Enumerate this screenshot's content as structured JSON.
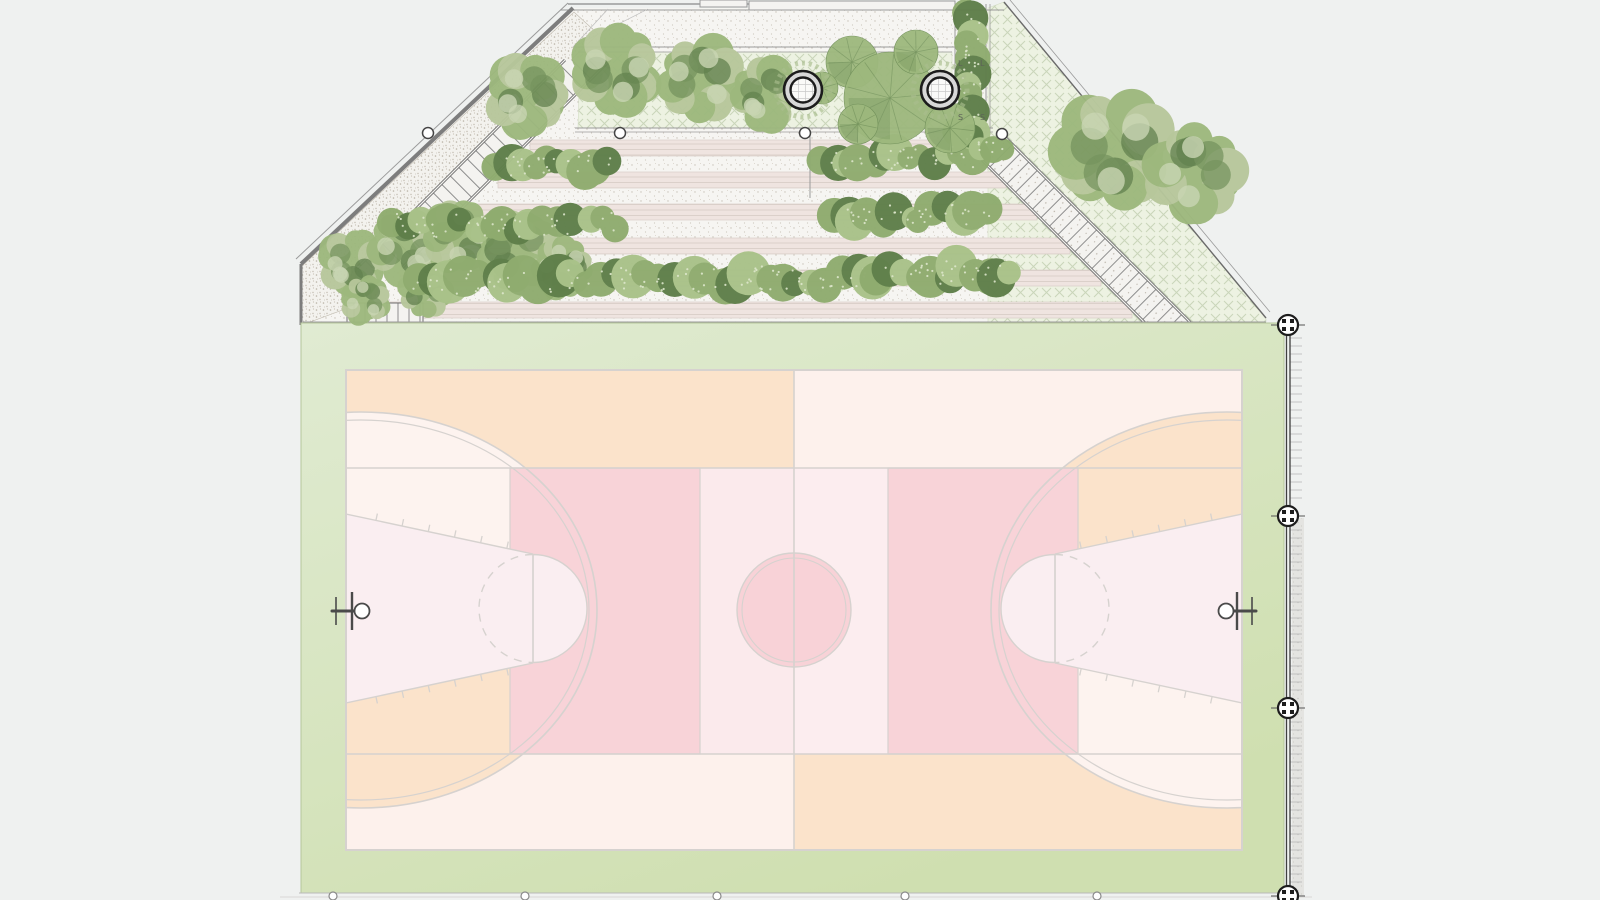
{
  "canvas": {
    "w": 1600,
    "h": 900,
    "bg": "#eff1f0"
  },
  "palette": {
    "bg": "#eff1f0",
    "paper": "#f6f5f2",
    "stipple_dot": "#c9c3b9",
    "terrace_band": "#efe4e0",
    "terrace_line": "#d9cec8",
    "hatch_bg": "#edf2e2",
    "hatch_line": "#c9d5b9",
    "wall": "#7d7d7d",
    "line_gray": "#9a9a9a",
    "light_line": "#bdbdbd",
    "stair_rail": "#6e6e6e",
    "tread": "#8e8e8e",
    "lawn_light": "#e0ebd2",
    "lawn": "#cfdfb0",
    "lawn_edge": "#b5c69b",
    "court_cream": "#fdf1ec",
    "court_peach": "#fbe3cb",
    "court_white": "#fdf3ef",
    "court_pink": "#f8d3d8",
    "court_lightpink_l": "#fbeaec",
    "court_lightpink_r": "#fcedef",
    "court_lane": "#faeef1",
    "court_circle": "#f8d2d7",
    "court_line": "#d6d2cf",
    "tree_base": "#9db87d",
    "tree_dark": "#71905a",
    "tree_deep": "#5d7d49",
    "tree_light": "#b7c79b",
    "tree_pale": "#c8d4b2",
    "hedge_base": "#8fac6f",
    "hedge_dark": "#5f7f4a",
    "hedge_light": "#a9c289",
    "hedge_speckle": "#dde7cb",
    "planter_ring": "#d8d8d8",
    "planter_stroke": "#1c1c1c",
    "planter_grid": "#c9c9c9",
    "organic_ring": "#a9bd8e",
    "fence": "#3f3f3f",
    "marker": "#1d1d1d",
    "tick": "#b8b8b8",
    "sidewalk": "#e4e4e1",
    "sidewalk_dot": "#c6c5c1",
    "node_stroke": "#444444",
    "hoop": "#4a4a4a",
    "label": "#5d6258"
  },
  "labels": {
    "plant_tags": [
      {
        "text": "L",
        "x": 958,
        "y": 66
      },
      {
        "text": "L",
        "x": 980,
        "y": 66
      },
      {
        "text": "S",
        "x": 958,
        "y": 120
      },
      {
        "text": "S",
        "x": 980,
        "y": 120
      }
    ]
  },
  "garden": {
    "base_polygon": [
      [
        573,
        8
      ],
      [
        988,
        8
      ],
      [
        988,
        131
      ],
      [
        1008,
        131
      ],
      [
        1197,
        322
      ],
      [
        303,
        322
      ],
      [
        303,
        264
      ]
    ],
    "hatch_areas": [
      {
        "name": "upper-planting-strip",
        "points": [
          [
            580,
            52
          ],
          [
            952,
            52
          ],
          [
            952,
            128
          ],
          [
            578,
            128
          ]
        ]
      },
      {
        "name": "east-meadow",
        "points": [
          [
            988,
            8
          ],
          [
            1004,
            2
          ],
          [
            1266,
            318
          ],
          [
            1266,
            322
          ],
          [
            988,
            322
          ]
        ]
      }
    ],
    "terrace_rows": [
      {
        "y0": 140,
        "y1": 156,
        "xl": 530,
        "xr": 958
      },
      {
        "y0": 172,
        "y1": 188,
        "xl": 498,
        "xr": 1006
      },
      {
        "y0": 204,
        "y1": 220,
        "xl": 466,
        "xr": 1037
      },
      {
        "y0": 238,
        "y1": 254,
        "xl": 432,
        "xr": 1070
      },
      {
        "y0": 270,
        "y1": 286,
        "xl": 400,
        "xr": 1101
      },
      {
        "y0": 302,
        "y1": 318,
        "xl": 368,
        "xr": 1132
      }
    ],
    "stipple_bed": [
      [
        302,
        266
      ],
      [
        574,
        12
      ],
      [
        598,
        34
      ],
      [
        356,
        268
      ],
      [
        356,
        305
      ],
      [
        302,
        325
      ]
    ],
    "stairs_left": {
      "band": [
        [
          565,
          60
        ],
        [
          610,
          60
        ],
        [
          402,
          268
        ],
        [
          357,
          268
        ]
      ]
    },
    "stairs_right": {
      "band": [
        [
          1005,
          137
        ],
        [
          1193,
          325
        ],
        [
          1170,
          348
        ],
        [
          982,
          160
        ]
      ]
    },
    "bottom_steps": {
      "rect": [
        347,
        303,
        76,
        19
      ]
    },
    "top_lines": [
      {
        "x1": 568,
        "y1": 4,
        "x2": 955,
        "y2": 4,
        "w": 1.5
      },
      {
        "x1": 560,
        "y1": 10,
        "x2": 1004,
        "y2": 10,
        "w": 1
      },
      {
        "x1": 573,
        "y1": 47,
        "x2": 958,
        "y2": 47,
        "w": 1
      },
      {
        "x1": 578,
        "y1": 52,
        "x2": 952,
        "y2": 52,
        "w": 0.8
      },
      {
        "x1": 575,
        "y1": 128,
        "x2": 993,
        "y2": 128,
        "w": 1
      },
      {
        "x1": 575,
        "y1": 132,
        "x2": 993,
        "y2": 132,
        "w": 0.8
      },
      {
        "x1": 303,
        "y1": 322,
        "x2": 1266,
        "y2": 322,
        "w": 1
      },
      {
        "x1": 955,
        "y1": 8,
        "x2": 955,
        "y2": 135,
        "w": 1
      },
      {
        "x1": 986,
        "y1": 4,
        "x2": 986,
        "y2": 135,
        "w": 1
      },
      {
        "x1": 990,
        "y1": 4,
        "x2": 990,
        "y2": 135,
        "w": 0.8
      },
      {
        "x1": 810,
        "y1": 134,
        "x2": 810,
        "y2": 198,
        "w": 1
      }
    ],
    "wall_lines": [
      {
        "x1": 301,
        "y1": 264,
        "x2": 573,
        "y2": 8,
        "w": 4,
        "c": "wall"
      },
      {
        "x1": 296,
        "y1": 259,
        "x2": 568,
        "y2": 3,
        "w": 1,
        "c": "line_gray"
      },
      {
        "x1": 301,
        "y1": 264,
        "x2": 301,
        "y2": 325,
        "w": 3,
        "c": "wall"
      }
    ],
    "leader_lines": [
      [
        573,
        47,
        608,
        9
      ],
      [
        573,
        47,
        648,
        9
      ]
    ],
    "wall_rects": [
      [
        700,
        0,
        47,
        7
      ],
      [
        749,
        1,
        206,
        9
      ]
    ],
    "nodes": [
      [
        428,
        133
      ],
      [
        620,
        133
      ],
      [
        805,
        133
      ],
      [
        1002,
        134
      ]
    ],
    "planters": [
      {
        "x": 803,
        "y": 90
      },
      {
        "x": 940,
        "y": 90
      }
    ],
    "planter_geo": {
      "outer_r": 19,
      "inner_r": 12.5,
      "organic_r": 27
    }
  },
  "vegetation": {
    "trees": [
      [
        527,
        95,
        42
      ],
      [
        616,
        70,
        46
      ],
      [
        700,
        79,
        45
      ],
      [
        766,
        94,
        37
      ],
      [
        352,
        262,
        34
      ],
      [
        406,
        246,
        40
      ],
      [
        460,
        236,
        38
      ],
      [
        516,
        250,
        44
      ],
      [
        563,
        268,
        33
      ],
      [
        425,
        292,
        28
      ],
      [
        365,
        300,
        26
      ],
      [
        1115,
        150,
        62
      ],
      [
        1195,
        172,
        50
      ]
    ],
    "circle_trees": [
      [
        852,
        62,
        26
      ],
      [
        890,
        98,
        46
      ],
      [
        858,
        124,
        20
      ],
      [
        916,
        52,
        22
      ],
      [
        950,
        128,
        25
      ],
      [
        822,
        88,
        16
      ]
    ],
    "hedges": [
      [
        497,
        168,
        610,
        164,
        30
      ],
      [
        392,
        226,
        616,
        224,
        34
      ],
      [
        422,
        282,
        874,
        278,
        36
      ],
      [
        824,
        160,
        973,
        157,
        30
      ],
      [
        832,
        216,
        986,
        213,
        32
      ],
      [
        876,
        274,
        1014,
        271,
        34
      ],
      [
        970,
        12,
        970,
        130,
        30
      ],
      [
        960,
        138,
        1000,
        150,
        26
      ]
    ]
  },
  "lawn": {
    "x": 301,
    "y": 323,
    "w": 983,
    "h": 570,
    "bottom_line_y": 893,
    "outer_line_y": 897,
    "edge_circles": [
      333,
      525,
      717,
      905,
      1097
    ],
    "circle_y": 896
  },
  "court": {
    "x": 346,
    "y": 370,
    "w": 896,
    "h": 480,
    "mid_x": 794,
    "band_y": [
      468,
      754
    ],
    "pink_rects": [
      [
        510,
        468,
        190,
        286
      ],
      [
        888,
        468,
        190,
        286
      ]
    ],
    "light_bands": [
      [
        700,
        468,
        94,
        286
      ],
      [
        794,
        468,
        94,
        286
      ]
    ],
    "center": {
      "x": 794,
      "y": 610,
      "r": 57,
      "r2": 52
    },
    "three_pt": {
      "rx": 236,
      "ry": 198,
      "rx2": 228,
      "ry2": 190,
      "cl": [
        361,
        610
      ],
      "cr": [
        1227,
        610
      ]
    },
    "lane": {
      "cy": 608.5,
      "base_half": 94.5,
      "ft_half": 54.5,
      "ftx_l": 533,
      "ftx_r": 1055,
      "ft_r": 54
    },
    "wedge_left": [
      [
        340,
        700
      ],
      [
        560,
        655
      ],
      [
        620,
        700
      ],
      [
        620,
        860
      ],
      [
        340,
        860
      ]
    ],
    "wedge_right": [
      [
        1248,
        520
      ],
      [
        1028,
        565
      ],
      [
        968,
        520
      ],
      [
        968,
        360
      ],
      [
        1248,
        360
      ]
    ],
    "hoops": {
      "ring_r": 7.5,
      "board_half": 19,
      "tee_half": 14,
      "left": {
        "arm": [
          332,
          356
        ],
        "tee_x": 336,
        "board_x": 352,
        "ring": [
          362,
          611
        ]
      },
      "right": {
        "arm": [
          1232,
          1256
        ],
        "tee_x": 1252,
        "board_x": 1237,
        "ring": [
          1226,
          611
        ]
      }
    }
  },
  "fence": {
    "x": 1286.5,
    "x2": 1290,
    "y0": 316,
    "y1": 898,
    "tick_x1": 1290,
    "tick_x2": 1302,
    "tick_step": 8,
    "marker_x": 1288,
    "markers": [
      325,
      516,
      708,
      896
    ],
    "sidewalk": [
      1292,
      518,
      12,
      380
    ],
    "diagonal": [
      [
        1004,
        2
      ],
      [
        1266,
        318
      ]
    ],
    "diagonal2": [
      [
        1010,
        0
      ],
      [
        1270,
        312
      ]
    ]
  }
}
